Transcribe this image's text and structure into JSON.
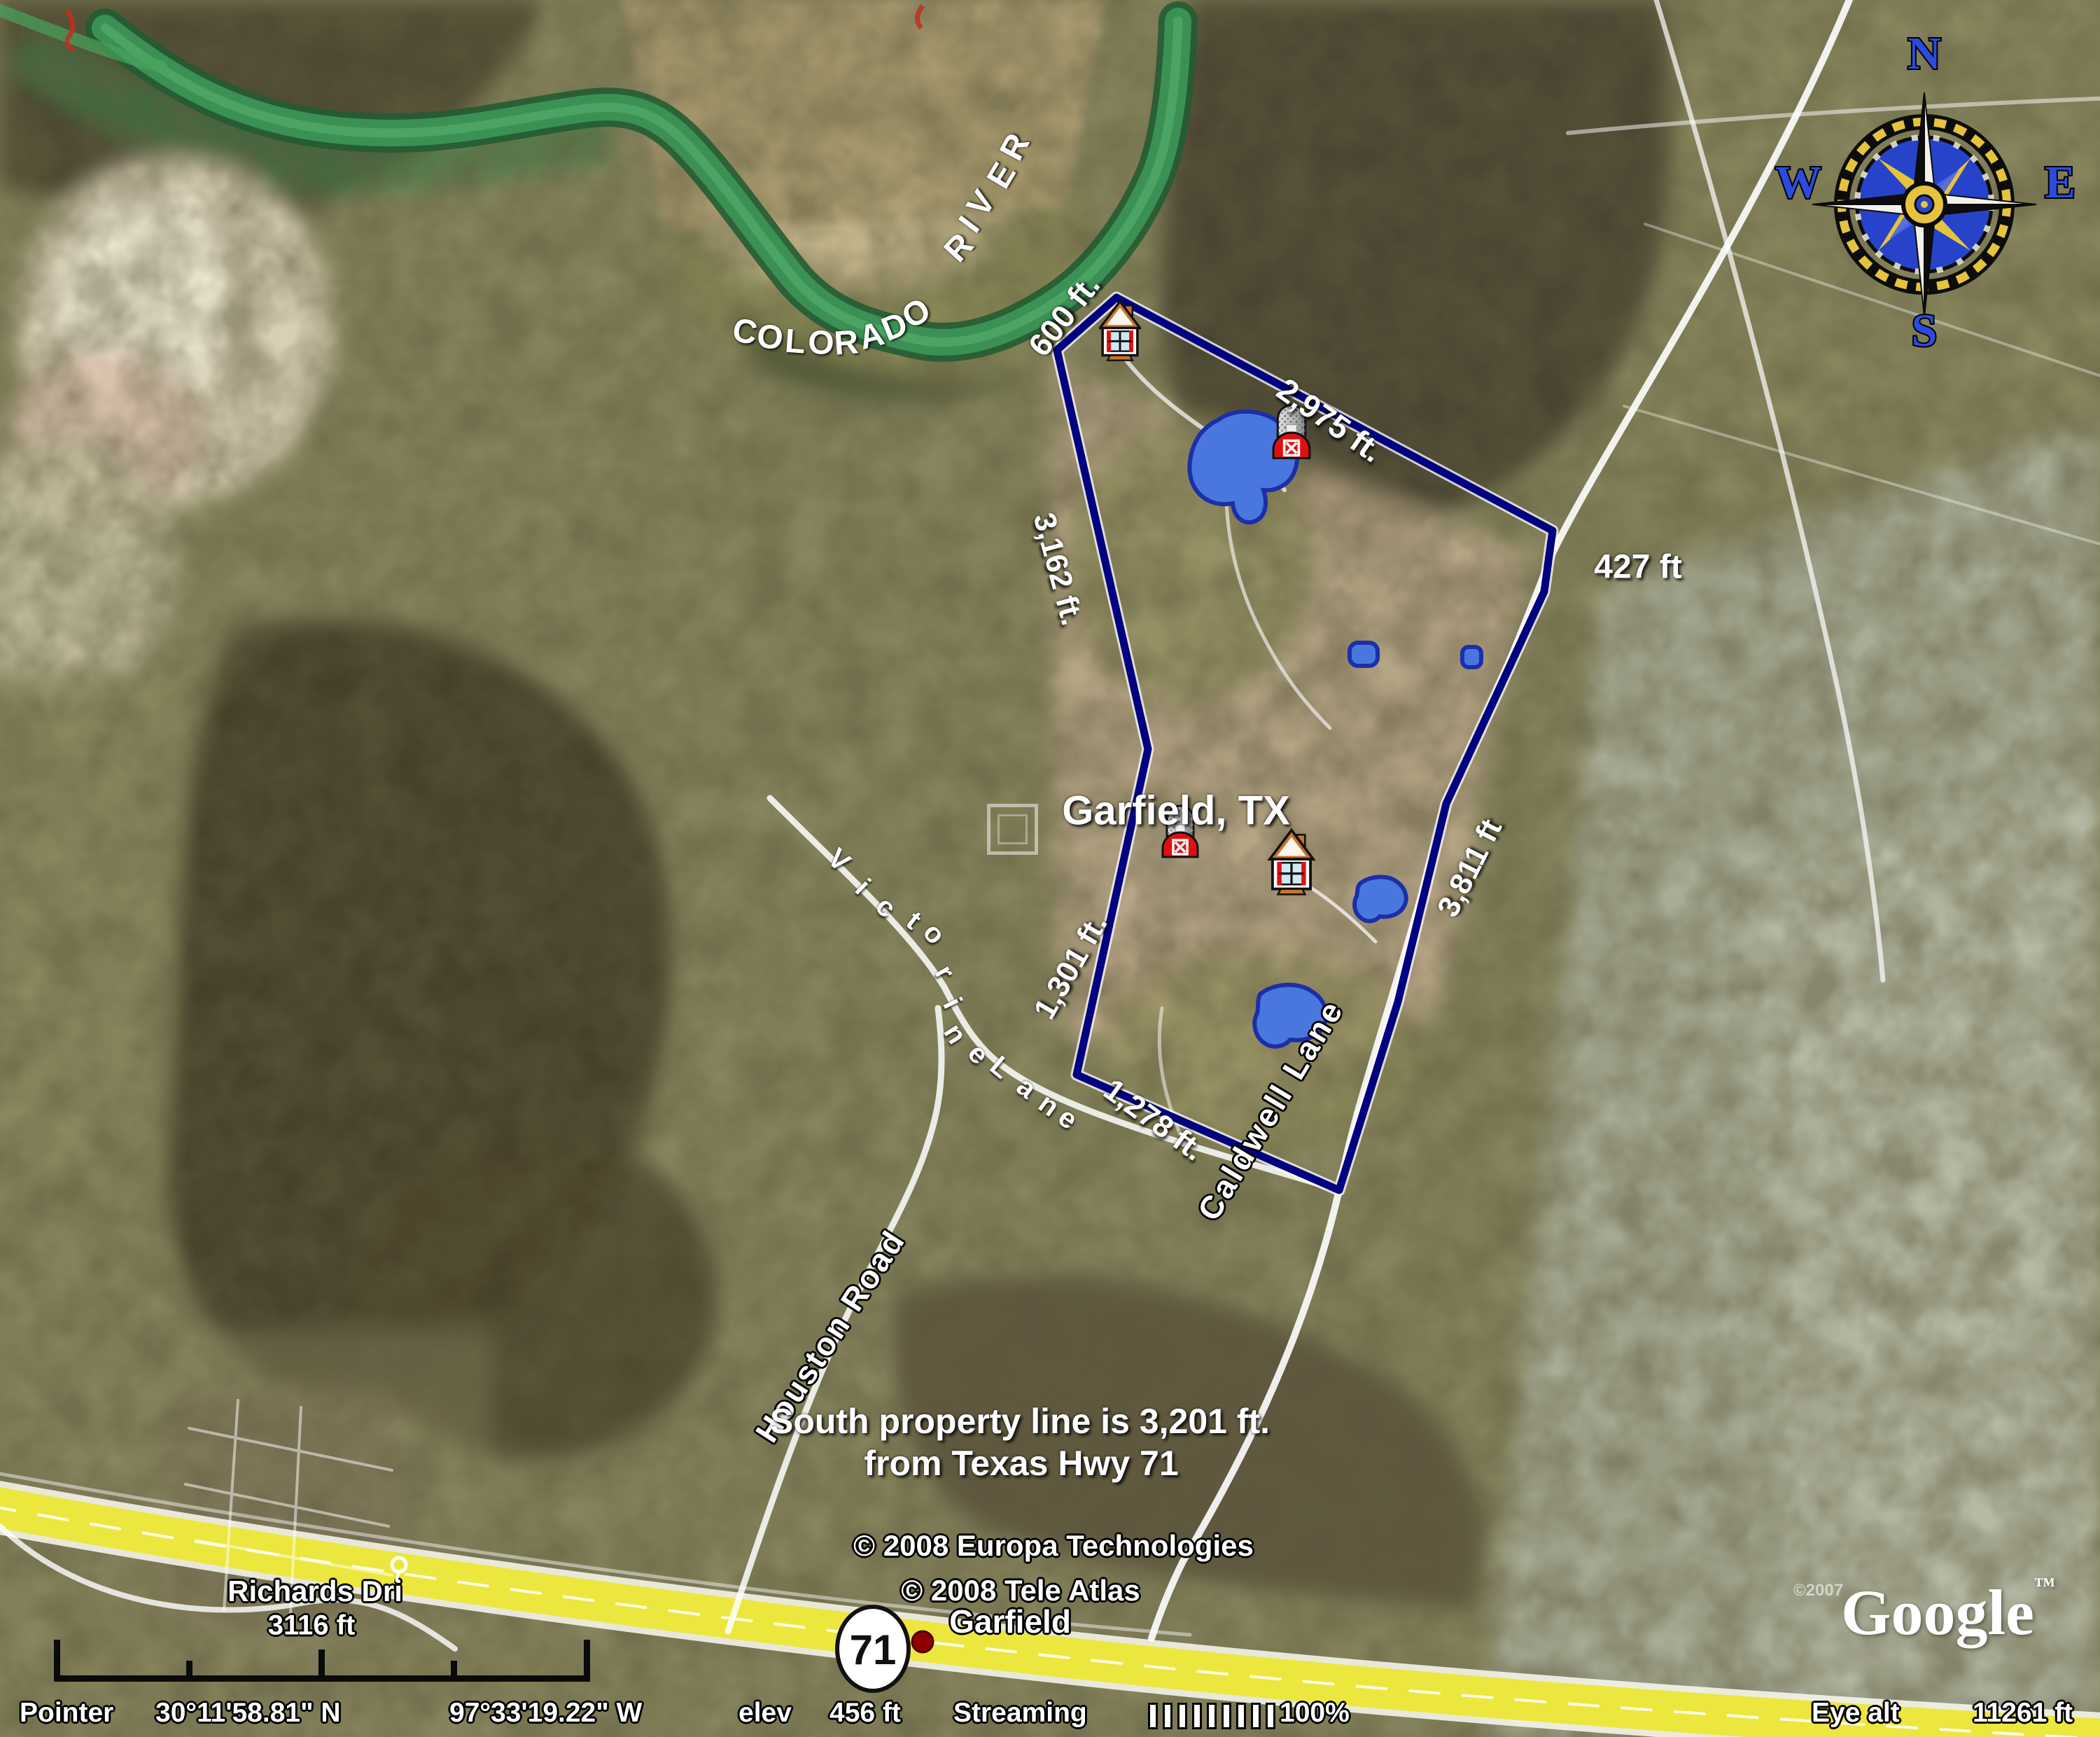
{
  "river_label": "COLORADO RIVER",
  "city_label": "Garfield, TX",
  "measurements": {
    "north_river": "600 ft.",
    "northeast": "2,975 ft.",
    "east_short": "427 ft",
    "west_upper": "3,162 ft.",
    "east_caldwell": "3,811 ft",
    "west_lower": "1,301 ft.",
    "south": "1,278 ft."
  },
  "roads": {
    "victorine": "Victorine Lane",
    "caldwell": "Caldwell Lane",
    "houston": "Houston Road",
    "richards": "Richards Dri"
  },
  "note": {
    "line1": "South property line is 3,201 ft.",
    "line2": "from Texas Hwy 71"
  },
  "scale": {
    "label": "3116 ft"
  },
  "highway_shield": "71",
  "town_label": "Garfield",
  "compass": {
    "north": "N",
    "south": "S",
    "east": "E",
    "west": "W"
  },
  "credits": {
    "europa": "© 2008 Europa Technologies",
    "teleatlas": "© 2008 Tele Atlas",
    "imagery_year": "©2007",
    "google": "Google",
    "trademark": "™"
  },
  "status_bar": {
    "pointer_label": "Pointer",
    "latitude": "30°11'58.81\" N",
    "longitude": "97°33'19.22\" W",
    "elev_label": "elev",
    "elev_value": "456 ft",
    "streaming_label": "Streaming",
    "streaming_pct": "100%",
    "eye_alt_label": "Eye alt",
    "eye_alt_value": "11261 ft"
  },
  "colors": {
    "property_line": "#000080",
    "pond_fill": "#4a77dd",
    "pond_stroke": "#1b2fa8",
    "highway": "#ece73f",
    "river": "#3b9155",
    "compass_letter": "#2b4be0",
    "badge_red": "#e01010"
  }
}
